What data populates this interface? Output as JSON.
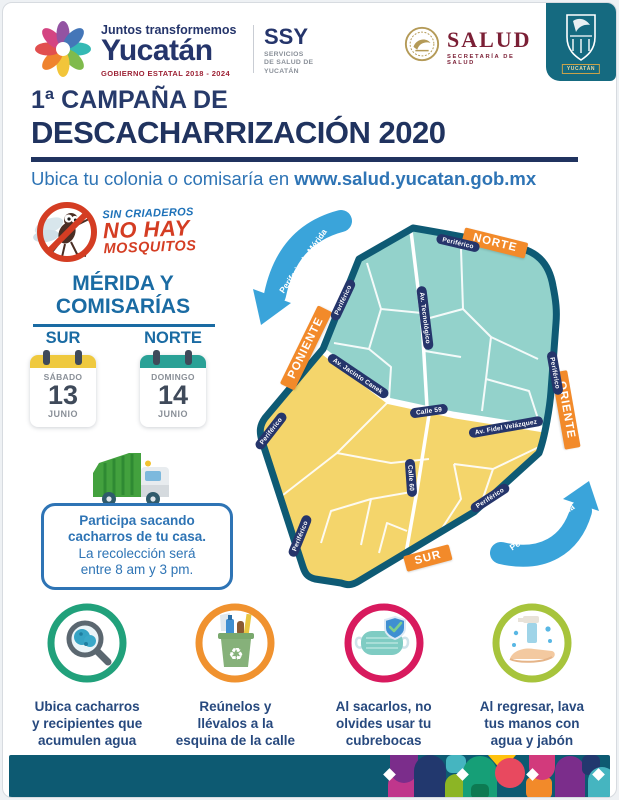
{
  "header": {
    "state_logo": {
      "tagline": "Juntos transformemos",
      "name": "Yucatán",
      "term": "GOBIERNO ESTATAL 2018 - 2024"
    },
    "ssy": {
      "acronym": "SSY",
      "line1": "SERVICIOS",
      "line2": "DE SALUD DE",
      "line3": "YUCATÁN"
    },
    "salud": {
      "name": "SALUD",
      "subtitle": "SECRETARÍA DE SALUD"
    },
    "badge": {
      "label": "YUCATÁN"
    }
  },
  "title": {
    "line1": "1ª CAMPAÑA DE",
    "line2": "DESCACHARRIZACIÓN 2020"
  },
  "subtitle": {
    "prefix": "Ubica tu colonia o comisaría en ",
    "url": "www.salud.yucatan.gob.mx"
  },
  "emblem": {
    "line1": "SIN CRIADEROS",
    "line2": "NO HAY",
    "line3": "MOSQUITOS"
  },
  "schedule": {
    "heading1": "MÉRIDA Y",
    "heading2": "COMISARÍAS",
    "zones": [
      {
        "zone": "SUR",
        "day": "SÁBADO",
        "date": "13",
        "month": "JUNIO",
        "header_color": "#efc93f"
      },
      {
        "zone": "NORTE",
        "day": "DOMINGO",
        "date": "14",
        "month": "JUNIO",
        "header_color": "#2aa196"
      }
    ]
  },
  "notice": {
    "line1": "Participa sacando",
    "line2": "cacharros de tu casa.",
    "line3": "La recolección será",
    "line4": "entre 8 am y 3 pm."
  },
  "map": {
    "ring_label": "Periférico",
    "directions": {
      "north": "NORTE",
      "west": "PONIENTE",
      "east": "ORIENTE",
      "south": "SUR"
    },
    "streets": {
      "tecnologico": "Av. Tecnológico",
      "jacinto_canek": "Av. Jacinto Canek",
      "calle_59": "Calle 59",
      "fidel_velazquez": "Av. Fidel Velázquez",
      "calle_60": "Calle 60"
    },
    "arrow_label": "Periferia de Mérida",
    "colors": {
      "north_zone": "#93d2cb",
      "south_zone": "#f4d56b",
      "ring": "#0e5a74",
      "banner": "#f28a2a",
      "street_pill": "#25356b",
      "arrow": "#3aa4da"
    }
  },
  "steps": [
    {
      "icon": "magnifier-icon",
      "ring_color": "#21a17b",
      "line1": "Ubica cacharros",
      "line2": "y recipientes que",
      "line3": "acumulen agua"
    },
    {
      "icon": "recycle-bin-icon",
      "ring_color": "#f0922f",
      "line1": "Reúnelos y",
      "line2": "llévalos a la",
      "line3": "esquina de la calle"
    },
    {
      "icon": "face-mask-icon",
      "ring_color": "#d81a5e",
      "line1": "Al sacarlos, no",
      "line2": "olvides usar tu",
      "line3": "cubrebocas"
    },
    {
      "icon": "hand-wash-icon",
      "ring_color": "#a7c43c",
      "line1": "Al regresar, lava",
      "line2": "tus manos con",
      "line3": "agua y jabón"
    }
  ]
}
